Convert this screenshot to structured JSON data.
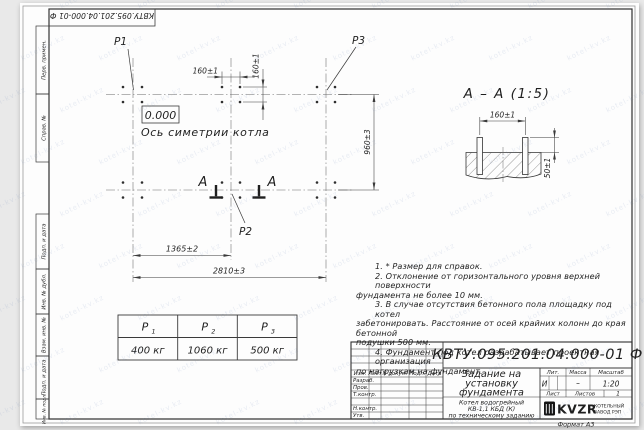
{
  "page": {
    "bg": "#e9e9e9",
    "sheet": "#fdfdfd",
    "line_color": "#3a3a3a"
  },
  "watermark": {
    "text": "kotel-kv.kz"
  },
  "corner_stamp": {
    "doc_number": "КВТУ.095.201.04.000-01 Ф"
  },
  "side_strip": {
    "cells": [
      "Перв. примен.",
      "Справ. №",
      "Подп. и дата",
      "Инв. № дубл.",
      "Взам. инв. №",
      "Подп. и дата",
      "Инв. № подл."
    ]
  },
  "plan": {
    "p1": "P1",
    "p2": "P2",
    "p3": "P3",
    "zero_level": "0.000",
    "axis_label": "Ось симетрии котла",
    "section_letter_left": "А",
    "section_letter_right": "А",
    "dim_160_h": "160±1",
    "dim_160_v": "160±1",
    "dim_960": "960±3",
    "dim_1365": "1365±2",
    "dim_2810": "2810±3"
  },
  "section": {
    "title": "А – А (1:5)",
    "dim_160": "160±1",
    "dim_50": "50±1"
  },
  "loads_table": {
    "headers": [
      {
        "sym": "P",
        "sub": "1"
      },
      {
        "sym": "P",
        "sub": "2"
      },
      {
        "sym": "P",
        "sub": "3"
      }
    ],
    "values": [
      "400 кг",
      "1060 кг",
      "500 кг"
    ]
  },
  "notes": {
    "lines": [
      "1. * Размер для справок.",
      "2. Отклонение от горизонтального уровня верхней поверхности",
      "фундамента не более 10 мм.",
      "3. В случае отсутствия бетонного пола площадку под котел",
      "забетонировать. Расстояние от осей крайних колонн до края бетонной",
      "подушки 500 мм.",
      "4. Фундамент под котел разрабатывает проектная организация",
      "по нагрузкам на фундамент."
    ]
  },
  "title_block": {
    "doc_number": "КВТУ.095.201.04.000-01 Ф",
    "rev_headers": [
      "Изм.",
      "Лист",
      "N докум.",
      "Подп.",
      "Дата"
    ],
    "sign_labels": [
      "Разраб.",
      "Пров.",
      "Т.контр.",
      "Н.контр.",
      "Утв."
    ],
    "title_lines": [
      "Задание на",
      "установку",
      "фундамента"
    ],
    "lit_headers": [
      "Лит.",
      "Масса",
      "Масштаб"
    ],
    "lit_values": [
      "И",
      "–",
      "1:20"
    ],
    "sheet_labels": [
      "Лист",
      "Листов"
    ],
    "sheets_value": "1",
    "product_lines": [
      "Котел водогрейный",
      "КВ-1,1 КБД (К)",
      "по техническому заданию"
    ],
    "logo_text": "KVZR",
    "org_lines": [
      "КОТЕЛЬНЫЙ",
      "ЗАВОД РЭП"
    ],
    "format_label": "Формат А3"
  }
}
